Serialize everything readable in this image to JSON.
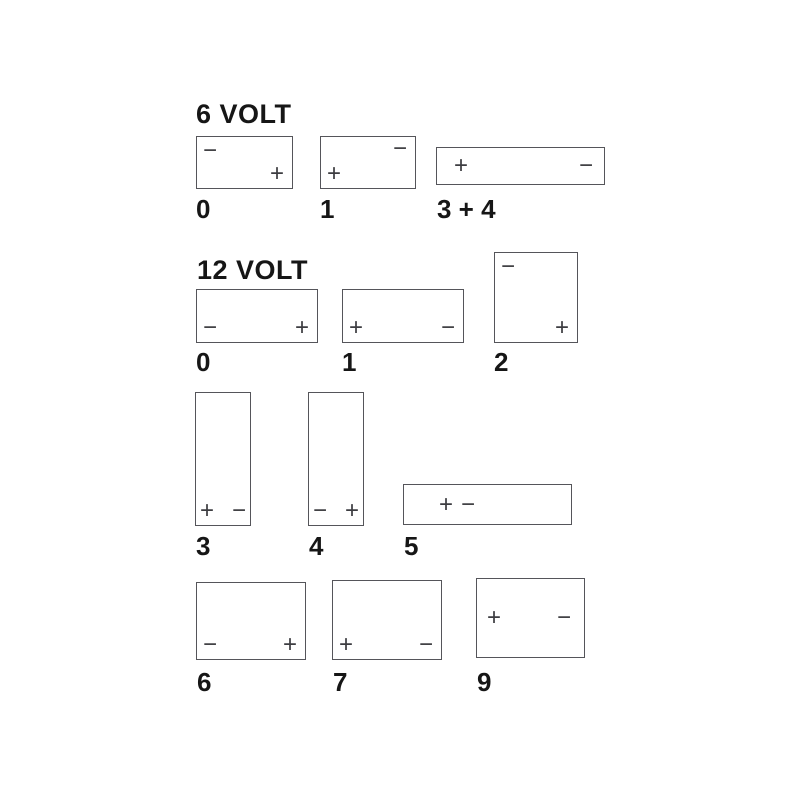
{
  "diagram": {
    "description_colors": {
      "background": "#ffffff",
      "box_border": "#55555a",
      "terminal_symbol": "#3d3d41",
      "text": "#161616"
    }
  },
  "sections": [
    {
      "title": "6 VOLT",
      "batteries": [
        {
          "label": "0",
          "terminals": [
            {
              "symbol": "−",
              "polarity": "negative",
              "position": "top-left"
            },
            {
              "symbol": "+",
              "polarity": "positive",
              "position": "bottom-right"
            }
          ]
        },
        {
          "label": "1",
          "terminals": [
            {
              "symbol": "−",
              "polarity": "negative",
              "position": "top-right"
            },
            {
              "symbol": "+",
              "polarity": "positive",
              "position": "bottom-left"
            }
          ]
        },
        {
          "label": "3 + 4",
          "terminals": [
            {
              "symbol": "+",
              "polarity": "positive",
              "position": "left-center"
            },
            {
              "symbol": "−",
              "polarity": "negative",
              "position": "right-center"
            }
          ]
        }
      ]
    },
    {
      "title": "12 VOLT",
      "batteries": [
        {
          "label": "0",
          "terminals": [
            {
              "symbol": "−",
              "polarity": "negative",
              "position": "bottom-left"
            },
            {
              "symbol": "+",
              "polarity": "positive",
              "position": "bottom-right"
            }
          ]
        },
        {
          "label": "1",
          "terminals": [
            {
              "symbol": "+",
              "polarity": "positive",
              "position": "bottom-left"
            },
            {
              "symbol": "−",
              "polarity": "negative",
              "position": "bottom-right"
            }
          ]
        },
        {
          "label": "2",
          "terminals": [
            {
              "symbol": "−",
              "polarity": "negative",
              "position": "top-left"
            },
            {
              "symbol": "+",
              "polarity": "positive",
              "position": "bottom-right"
            }
          ]
        },
        {
          "label": "3",
          "terminals": [
            {
              "symbol": "+",
              "polarity": "positive",
              "position": "bottom-left"
            },
            {
              "symbol": "−",
              "polarity": "negative",
              "position": "bottom-right"
            }
          ]
        },
        {
          "label": "4",
          "terminals": [
            {
              "symbol": "−",
              "polarity": "negative",
              "position": "bottom-left"
            },
            {
              "symbol": "+",
              "polarity": "positive",
              "position": "bottom-right"
            }
          ]
        },
        {
          "label": "5",
          "terminals": [
            {
              "symbol": "+",
              "polarity": "positive",
              "position": "left-of-center"
            },
            {
              "symbol": "−",
              "polarity": "negative",
              "position": "left-of-center"
            }
          ]
        },
        {
          "label": "6",
          "terminals": [
            {
              "symbol": "−",
              "polarity": "negative",
              "position": "bottom-left"
            },
            {
              "symbol": "+",
              "polarity": "positive",
              "position": "bottom-right"
            }
          ]
        },
        {
          "label": "7",
          "terminals": [
            {
              "symbol": "+",
              "polarity": "positive",
              "position": "bottom-left"
            },
            {
              "symbol": "−",
              "polarity": "negative",
              "position": "bottom-right"
            }
          ]
        },
        {
          "label": "9",
          "terminals": [
            {
              "symbol": "+",
              "polarity": "positive",
              "position": "left-center"
            },
            {
              "symbol": "−",
              "polarity": "negative",
              "position": "right-center"
            }
          ]
        }
      ]
    }
  ]
}
